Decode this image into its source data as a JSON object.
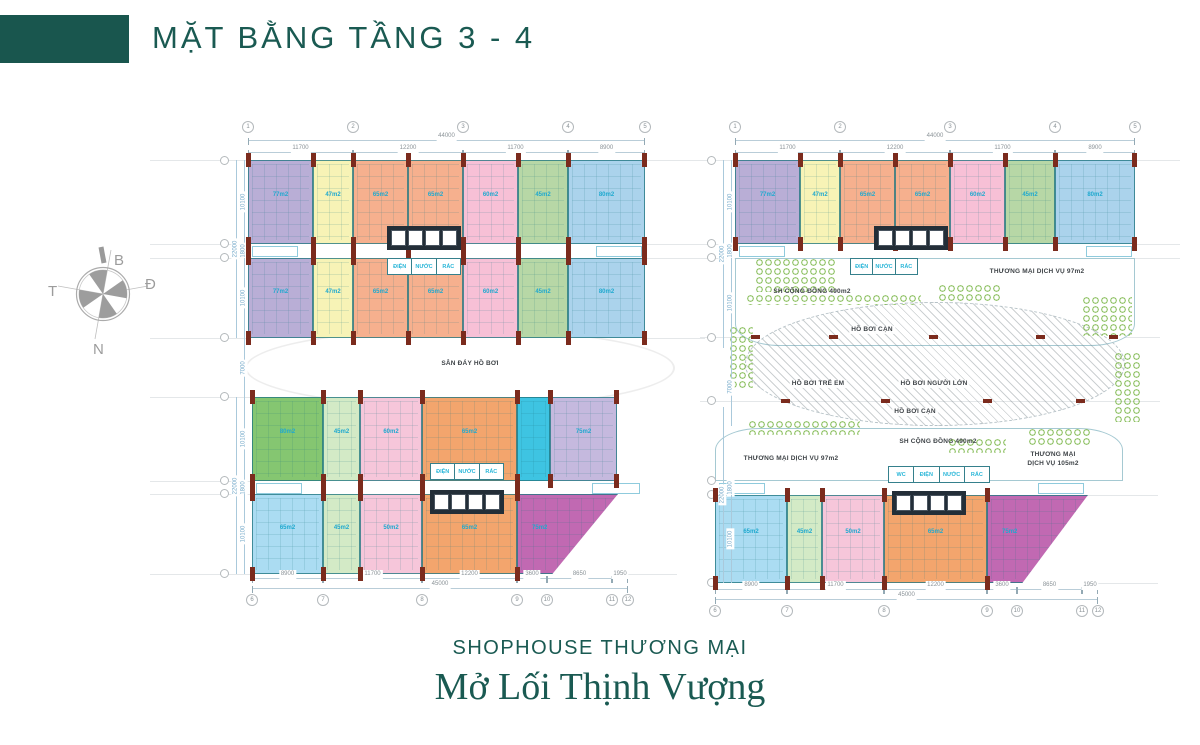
{
  "header": {
    "title": "MẶT BẰNG TẦNG 3 - 4"
  },
  "compass": {
    "north": "B",
    "east": "Đ",
    "south": "N",
    "west": "T"
  },
  "footer": {
    "subtitle": "SHOPHOUSE THƯƠNG MẠI",
    "slogan": "Mở Lối Thịnh Vượng"
  },
  "palette": {
    "brand_teal": "#1a5a52",
    "line_teal": "#35808c",
    "area_cyan": "#1fa9cf",
    "column_red": "#7b2b1d",
    "dim_gray": "#8a9297",
    "dim_blue": "#74a9c9",
    "landscape_green": "#7ab648"
  },
  "plan": {
    "deck_ellipse": {
      "x": 245,
      "y": 328,
      "w": 430,
      "h": 80
    },
    "pool": {
      "x": 745,
      "y": 302,
      "w": 380,
      "h": 124
    },
    "amenities": [
      {
        "cls": "amen-top",
        "x": 735,
        "y": 258,
        "w": 400,
        "h": 88
      },
      {
        "cls": "amen-bottom",
        "x": 715,
        "y": 428,
        "w": 408,
        "h": 53
      }
    ],
    "units": [
      {
        "n": "purple",
        "c": "#b9aed6",
        "x": 248,
        "y": 160,
        "w": 65,
        "h": 84,
        "a": "77m2"
      },
      {
        "n": "yellow",
        "c": "#f7f3b6",
        "x": 313,
        "y": 160,
        "w": 40,
        "h": 84,
        "a": "47m2"
      },
      {
        "n": "orange",
        "c": "#f6b08e",
        "x": 353,
        "y": 160,
        "w": 55,
        "h": 84,
        "a": "65m2"
      },
      {
        "n": "orange",
        "c": "#f6b08e",
        "x": 408,
        "y": 160,
        "w": 55,
        "h": 84,
        "a": "65m2"
      },
      {
        "n": "pink",
        "c": "#f7c0d6",
        "x": 463,
        "y": 160,
        "w": 55,
        "h": 84,
        "a": "60m2"
      },
      {
        "n": "green",
        "c": "#b7d7a6",
        "x": 518,
        "y": 160,
        "w": 50,
        "h": 84,
        "a": "45m2"
      },
      {
        "n": "blue",
        "c": "#abd3ec",
        "x": 568,
        "y": 160,
        "w": 77,
        "h": 84,
        "a": "80m2",
        "end": true
      },
      {
        "n": "purple",
        "c": "#b9aed6",
        "x": 248,
        "y": 258,
        "w": 65,
        "h": 80,
        "a": "77m2"
      },
      {
        "n": "yellow",
        "c": "#f7f3b6",
        "x": 313,
        "y": 258,
        "w": 40,
        "h": 80,
        "a": "47m2"
      },
      {
        "n": "orange",
        "c": "#f6b08e",
        "x": 353,
        "y": 258,
        "w": 55,
        "h": 80,
        "a": "65m2"
      },
      {
        "n": "orange",
        "c": "#f6b08e",
        "x": 408,
        "y": 258,
        "w": 55,
        "h": 80,
        "a": "65m2"
      },
      {
        "n": "pink",
        "c": "#f7c0d6",
        "x": 463,
        "y": 258,
        "w": 55,
        "h": 80,
        "a": "60m2"
      },
      {
        "n": "green",
        "c": "#b7d7a6",
        "x": 518,
        "y": 258,
        "w": 50,
        "h": 80,
        "a": "45m2"
      },
      {
        "n": "blue",
        "c": "#abd3ec",
        "x": 568,
        "y": 258,
        "w": 77,
        "h": 80,
        "a": "80m2",
        "end": true
      },
      {
        "n": "purple",
        "c": "#b9aed6",
        "x": 735,
        "y": 160,
        "w": 65,
        "h": 84,
        "a": "77m2"
      },
      {
        "n": "yellow",
        "c": "#f7f3b6",
        "x": 800,
        "y": 160,
        "w": 40,
        "h": 84,
        "a": "47m2"
      },
      {
        "n": "orange",
        "c": "#f6b08e",
        "x": 840,
        "y": 160,
        "w": 55,
        "h": 84,
        "a": "65m2"
      },
      {
        "n": "orange",
        "c": "#f6b08e",
        "x": 895,
        "y": 160,
        "w": 55,
        "h": 84,
        "a": "65m2"
      },
      {
        "n": "pink",
        "c": "#f7c0d6",
        "x": 950,
        "y": 160,
        "w": 55,
        "h": 84,
        "a": "60m2"
      },
      {
        "n": "green",
        "c": "#b7d7a6",
        "x": 1005,
        "y": 160,
        "w": 50,
        "h": 84,
        "a": "45m2"
      },
      {
        "n": "blue",
        "c": "#abd3ec",
        "x": 1055,
        "y": 160,
        "w": 80,
        "h": 84,
        "a": "80m2",
        "end": true
      },
      {
        "n": "dark-green",
        "c": "#85c671",
        "x": 252,
        "y": 397,
        "w": 71,
        "h": 84,
        "a": "80m2"
      },
      {
        "n": "light-green",
        "c": "#d3eac6",
        "x": 323,
        "y": 397,
        "w": 37,
        "h": 84,
        "a": "45m2"
      },
      {
        "n": "pink",
        "c": "#f6c6da",
        "x": 360,
        "y": 397,
        "w": 62,
        "h": 84,
        "a": "60m2"
      },
      {
        "n": "orange",
        "c": "#f3a56d",
        "x": 422,
        "y": 397,
        "w": 95,
        "h": 84,
        "a": "65m2"
      },
      {
        "n": "cyan",
        "c": "#3ec4e2",
        "x": 517,
        "y": 397,
        "w": 33,
        "h": 84
      },
      {
        "n": "lavender",
        "c": "#c5b9de",
        "x": 550,
        "y": 397,
        "w": 67,
        "h": 84,
        "a": "75m2",
        "end": true
      },
      {
        "n": "blue",
        "c": "#abdcf2",
        "x": 252,
        "y": 494,
        "w": 71,
        "h": 80,
        "a": "65m2"
      },
      {
        "n": "light-green",
        "c": "#d3eac6",
        "x": 323,
        "y": 494,
        "w": 37,
        "h": 80,
        "a": "45m2"
      },
      {
        "n": "pink",
        "c": "#f6c6da",
        "x": 360,
        "y": 494,
        "w": 62,
        "h": 80,
        "a": "50m2"
      },
      {
        "n": "orange",
        "c": "#f3a56d",
        "x": 422,
        "y": 494,
        "w": 95,
        "h": 80,
        "a": "65m2"
      },
      {
        "n": "magenta",
        "c": "#c169b2",
        "x": 517,
        "y": 494,
        "w": 101,
        "h": 80,
        "a": "75m2",
        "clip": "polygon(0 0,100% 0,35% 100%,0 100%)"
      },
      {
        "n": "blue",
        "c": "#abdcf2",
        "x": 715,
        "y": 495,
        "w": 72,
        "h": 88,
        "a": "65m2"
      },
      {
        "n": "light-green",
        "c": "#d3eac6",
        "x": 787,
        "y": 495,
        "w": 35,
        "h": 88,
        "a": "45m2"
      },
      {
        "n": "pink",
        "c": "#f6c6da",
        "x": 822,
        "y": 495,
        "w": 62,
        "h": 88,
        "a": "50m2"
      },
      {
        "n": "orange",
        "c": "#f3a56d",
        "x": 884,
        "y": 495,
        "w": 103,
        "h": 88,
        "a": "65m2"
      },
      {
        "n": "magenta",
        "c": "#c169b2",
        "x": 987,
        "y": 495,
        "w": 101,
        "h": 88,
        "a": "75m2",
        "clip": "polygon(0 0,100% 0,35% 100%,0 100%)"
      }
    ],
    "cores": [
      {
        "x": 387,
        "y": 226,
        "w": 74,
        "h": 24
      },
      {
        "x": 874,
        "y": 226,
        "w": 74,
        "h": 24
      },
      {
        "x": 430,
        "y": 490,
        "w": 74,
        "h": 24
      },
      {
        "x": 892,
        "y": 491,
        "w": 74,
        "h": 24
      }
    ],
    "services": [
      {
        "x": 387,
        "y": 258,
        "w": 74,
        "h": 17,
        "labels": [
          "ĐIỆN",
          "NƯỚC",
          "RÁC"
        ]
      },
      {
        "x": 850,
        "y": 258,
        "w": 68,
        "h": 17,
        "labels": [
          "ĐIỆN",
          "NƯỚC",
          "RÁC"
        ]
      },
      {
        "x": 430,
        "y": 463,
        "w": 74,
        "h": 17,
        "labels": [
          "ĐIỆN",
          "NƯỚC",
          "RÁC"
        ]
      },
      {
        "x": 888,
        "y": 466,
        "w": 102,
        "h": 17,
        "labels": [
          "WC",
          "ĐIỆN",
          "NƯỚC",
          "RÁC"
        ]
      }
    ],
    "texts": [
      {
        "t": "SÂN ĐÁY HỒ BƠI",
        "x": 470,
        "y": 360,
        "bg": true
      },
      {
        "t": "SH CỘNG ĐỒNG 490m2",
        "x": 812,
        "y": 288
      },
      {
        "t": "THƯƠNG MẠI DỊCH VỤ 97m2",
        "x": 1037,
        "y": 268
      },
      {
        "t": "HỒ BƠI CẠN",
        "x": 872,
        "y": 326,
        "bg": true
      },
      {
        "t": "HỒ BƠI TRẺ EM",
        "x": 818,
        "y": 380,
        "bg": true
      },
      {
        "t": "HỒ BƠI NGƯỜI LỚN",
        "x": 934,
        "y": 380,
        "bg": true
      },
      {
        "t": "HỒ BƠI CẠN",
        "x": 915,
        "y": 408,
        "bg": true
      },
      {
        "t": "THƯƠNG MẠI DỊCH VỤ 97m2",
        "x": 791,
        "y": 455
      },
      {
        "t": "SH CỘNG ĐỒNG 490m2",
        "x": 938,
        "y": 438
      },
      {
        "t": "THƯƠNG MẠI",
        "x": 1053,
        "y": 451
      },
      {
        "t": "DỊCH VỤ 105m2",
        "x": 1053,
        "y": 460
      }
    ],
    "dims": [
      {
        "x": 248,
        "y": 140,
        "w": 397,
        "label": "44000"
      },
      {
        "x": 248,
        "y": 152,
        "w": 105,
        "label": "11700"
      },
      {
        "x": 353,
        "y": 152,
        "w": 110,
        "label": "12200"
      },
      {
        "x": 463,
        "y": 152,
        "w": 105,
        "label": "11700"
      },
      {
        "x": 568,
        "y": 152,
        "w": 77,
        "label": "8900"
      },
      {
        "x": 735,
        "y": 140,
        "w": 400,
        "label": "44000"
      },
      {
        "x": 735,
        "y": 152,
        "w": 105,
        "label": "11700"
      },
      {
        "x": 840,
        "y": 152,
        "w": 110,
        "label": "12200"
      },
      {
        "x": 950,
        "y": 152,
        "w": 105,
        "label": "11700"
      },
      {
        "x": 1055,
        "y": 152,
        "w": 80,
        "label": "8900"
      },
      {
        "x": 252,
        "y": 578,
        "w": 71,
        "label": "8900"
      },
      {
        "x": 323,
        "y": 578,
        "w": 99,
        "label": "11700"
      },
      {
        "x": 422,
        "y": 578,
        "w": 95,
        "label": "12200"
      },
      {
        "x": 517,
        "y": 578,
        "w": 30,
        "label": "3600"
      },
      {
        "x": 547,
        "y": 578,
        "w": 65,
        "label": "8650"
      },
      {
        "x": 612,
        "y": 578,
        "w": 16,
        "label": "1950"
      },
      {
        "x": 252,
        "y": 588,
        "w": 376,
        "label": "45000"
      },
      {
        "x": 715,
        "y": 589,
        "w": 72,
        "label": "8900"
      },
      {
        "x": 787,
        "y": 589,
        "w": 97,
        "label": "11700"
      },
      {
        "x": 884,
        "y": 589,
        "w": 103,
        "label": "12200"
      },
      {
        "x": 987,
        "y": 589,
        "w": 30,
        "label": "3600"
      },
      {
        "x": 1017,
        "y": 589,
        "w": 65,
        "label": "8650"
      },
      {
        "x": 1082,
        "y": 589,
        "w": 16,
        "label": "1950"
      },
      {
        "x": 715,
        "y": 599,
        "w": 383,
        "label": "45000"
      }
    ],
    "vdims": [
      {
        "x": 236,
        "y": 160,
        "h": 178,
        "label": "22000"
      },
      {
        "x": 244,
        "y": 160,
        "h": 84,
        "label": "10100"
      },
      {
        "x": 244,
        "y": 244,
        "h": 14,
        "label": "1800"
      },
      {
        "x": 244,
        "y": 258,
        "h": 80,
        "label": "10100"
      },
      {
        "x": 244,
        "y": 338,
        "h": 59,
        "label": "7000"
      },
      {
        "x": 236,
        "y": 397,
        "h": 177,
        "label": "22000"
      },
      {
        "x": 244,
        "y": 397,
        "h": 84,
        "label": "10100"
      },
      {
        "x": 244,
        "y": 481,
        "h": 13,
        "label": "1800"
      },
      {
        "x": 244,
        "y": 494,
        "h": 80,
        "label": "10100"
      },
      {
        "x": 723,
        "y": 160,
        "h": 188,
        "label": "22000"
      },
      {
        "x": 731,
        "y": 160,
        "h": 84,
        "label": "10100"
      },
      {
        "x": 731,
        "y": 244,
        "h": 14,
        "label": "1800"
      },
      {
        "x": 731,
        "y": 258,
        "h": 90,
        "label": "10100"
      },
      {
        "x": 731,
        "y": 348,
        "h": 78,
        "label": "7000"
      },
      {
        "x": 723,
        "y": 407,
        "h": 176,
        "label": "22000"
      },
      {
        "x": 731,
        "y": 480,
        "h": 15,
        "label": "1800"
      },
      {
        "x": 731,
        "y": 495,
        "h": 88,
        "label": "10100"
      }
    ],
    "bubbles": [
      {
        "x": 248,
        "y": 127,
        "label": "1"
      },
      {
        "x": 353,
        "y": 127,
        "label": "2"
      },
      {
        "x": 463,
        "y": 127,
        "label": "3"
      },
      {
        "x": 568,
        "y": 127,
        "label": "4"
      },
      {
        "x": 645,
        "y": 127,
        "label": "5"
      },
      {
        "x": 735,
        "y": 127,
        "label": "1"
      },
      {
        "x": 840,
        "y": 127,
        "label": "2"
      },
      {
        "x": 950,
        "y": 127,
        "label": "3"
      },
      {
        "x": 1055,
        "y": 127,
        "label": "4"
      },
      {
        "x": 1135,
        "y": 127,
        "label": "5"
      },
      {
        "x": 252,
        "y": 600,
        "label": "6"
      },
      {
        "x": 323,
        "y": 600,
        "label": "7"
      },
      {
        "x": 422,
        "y": 600,
        "label": "8"
      },
      {
        "x": 517,
        "y": 600,
        "label": "9"
      },
      {
        "x": 547,
        "y": 600,
        "label": "10"
      },
      {
        "x": 612,
        "y": 600,
        "label": "11"
      },
      {
        "x": 628,
        "y": 600,
        "label": "12"
      },
      {
        "x": 715,
        "y": 611,
        "label": "6"
      },
      {
        "x": 787,
        "y": 611,
        "label": "7"
      },
      {
        "x": 884,
        "y": 611,
        "label": "8"
      },
      {
        "x": 987,
        "y": 611,
        "label": "9"
      },
      {
        "x": 1017,
        "y": 611,
        "label": "10"
      },
      {
        "x": 1082,
        "y": 611,
        "label": "11"
      },
      {
        "x": 1098,
        "y": 611,
        "label": "12"
      }
    ],
    "side_bubbles": [
      {
        "x": 224,
        "y": 160
      },
      {
        "x": 224,
        "y": 243
      },
      {
        "x": 224,
        "y": 257
      },
      {
        "x": 224,
        "y": 337
      },
      {
        "x": 224,
        "y": 396
      },
      {
        "x": 224,
        "y": 480
      },
      {
        "x": 224,
        "y": 493
      },
      {
        "x": 224,
        "y": 573
      },
      {
        "x": 711,
        "y": 160
      },
      {
        "x": 711,
        "y": 243
      },
      {
        "x": 711,
        "y": 257
      },
      {
        "x": 711,
        "y": 337
      },
      {
        "x": 711,
        "y": 400
      },
      {
        "x": 711,
        "y": 480
      },
      {
        "x": 711,
        "y": 494
      },
      {
        "x": 711,
        "y": 582
      }
    ],
    "gridlines": [
      {
        "x": 150,
        "y": 160,
        "w": 98
      },
      {
        "x": 150,
        "y": 244,
        "w": 98
      },
      {
        "x": 150,
        "y": 258,
        "w": 98
      },
      {
        "x": 150,
        "y": 338,
        "w": 98
      },
      {
        "x": 150,
        "y": 397,
        "w": 102
      },
      {
        "x": 150,
        "y": 481,
        "w": 102
      },
      {
        "x": 150,
        "y": 494,
        "w": 102
      },
      {
        "x": 150,
        "y": 574,
        "w": 102
      },
      {
        "x": 645,
        "y": 160,
        "w": 90
      },
      {
        "x": 645,
        "y": 244,
        "w": 90
      },
      {
        "x": 645,
        "y": 258,
        "w": 90
      },
      {
        "x": 645,
        "y": 338,
        "w": 60
      },
      {
        "x": 617,
        "y": 574,
        "w": 60
      },
      {
        "x": 1135,
        "y": 160,
        "w": 45
      },
      {
        "x": 1135,
        "y": 244,
        "w": 45
      },
      {
        "x": 1135,
        "y": 258,
        "w": 45
      },
      {
        "x": 700,
        "y": 337,
        "w": 460
      },
      {
        "x": 700,
        "y": 401,
        "w": 460
      },
      {
        "x": 1088,
        "y": 495,
        "w": 70
      },
      {
        "x": 1098,
        "y": 583,
        "w": 60
      }
    ],
    "red_ticks": [
      {
        "x": 755,
        "y": 337
      },
      {
        "x": 833,
        "y": 337
      },
      {
        "x": 933,
        "y": 337
      },
      {
        "x": 1040,
        "y": 337
      },
      {
        "x": 1113,
        "y": 337
      },
      {
        "x": 785,
        "y": 401
      },
      {
        "x": 885,
        "y": 401
      },
      {
        "x": 987,
        "y": 401
      },
      {
        "x": 1080,
        "y": 401
      }
    ],
    "fixtures": [
      {
        "x": 252,
        "y": 246,
        "w": 46,
        "h": 11
      },
      {
        "x": 596,
        "y": 246,
        "w": 46,
        "h": 11
      },
      {
        "x": 256,
        "y": 483,
        "w": 46,
        "h": 11
      },
      {
        "x": 592,
        "y": 483,
        "w": 48,
        "h": 11
      },
      {
        "x": 739,
        "y": 246,
        "w": 46,
        "h": 11
      },
      {
        "x": 1086,
        "y": 246,
        "w": 46,
        "h": 11
      },
      {
        "x": 719,
        "y": 483,
        "w": 46,
        "h": 11
      },
      {
        "x": 1038,
        "y": 483,
        "w": 46,
        "h": 11
      }
    ],
    "greens": [
      {
        "x": 755,
        "y": 258,
        "w": 82,
        "h": 34
      },
      {
        "x": 938,
        "y": 284,
        "w": 62,
        "h": 18
      },
      {
        "x": 746,
        "y": 294,
        "w": 175,
        "h": 11
      },
      {
        "x": 1082,
        "y": 296,
        "w": 50,
        "h": 40
      },
      {
        "x": 1114,
        "y": 352,
        "w": 26,
        "h": 70
      },
      {
        "x": 729,
        "y": 326,
        "w": 24,
        "h": 62
      },
      {
        "x": 748,
        "y": 420,
        "w": 112,
        "h": 15
      },
      {
        "x": 948,
        "y": 438,
        "w": 58,
        "h": 15
      },
      {
        "x": 1028,
        "y": 428,
        "w": 64,
        "h": 18
      }
    ]
  }
}
